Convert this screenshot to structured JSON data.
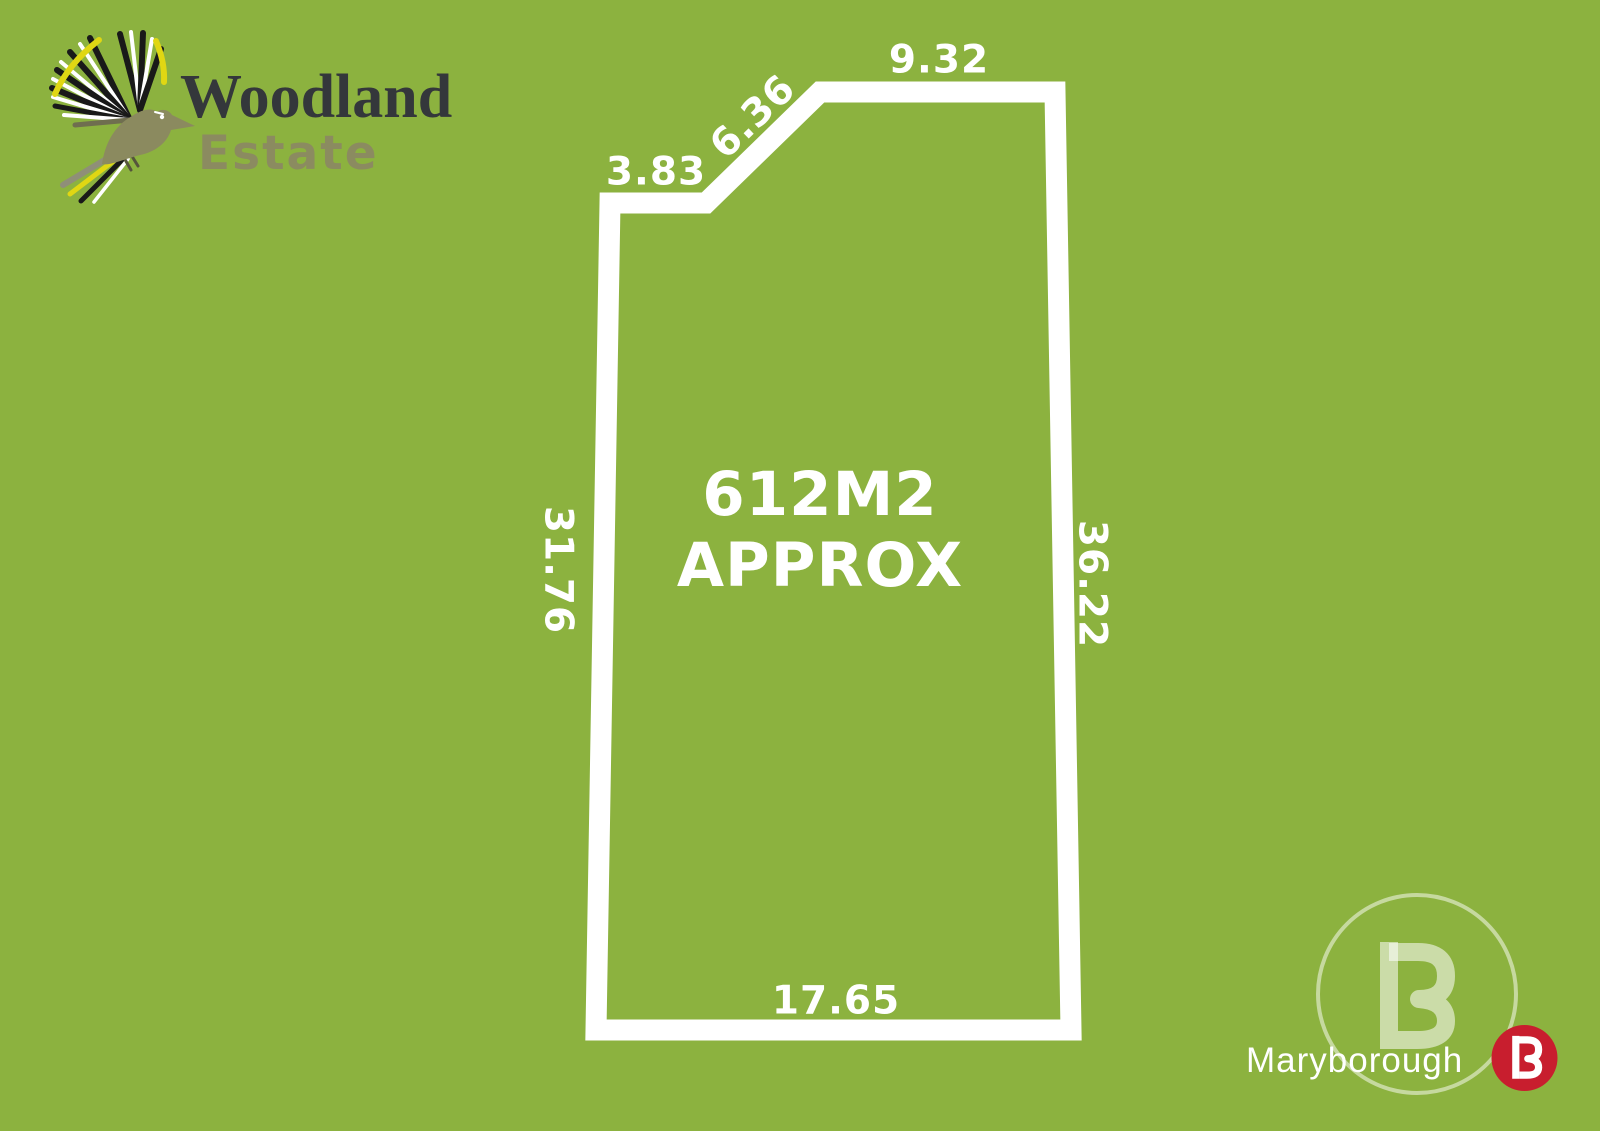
{
  "page": {
    "background_color": "#8cb23f",
    "boundary_color": "#ffffff"
  },
  "brand": {
    "line1": "Woodland",
    "line2": "Estate",
    "line1_color": "#34373b",
    "line2_color": "#8b8b60",
    "icon": "bird-icon"
  },
  "lot": {
    "area": {
      "line1": "612M2",
      "line2": "APPROX"
    },
    "dimensions": {
      "top": "9.32",
      "diagonal": "6.36",
      "upper_left": "3.83",
      "left": "31.76",
      "right": "36.22",
      "bottom": "17.65"
    }
  },
  "agency": {
    "name": "Maryborough",
    "monogram": "B",
    "badge_color": "#c81e2e",
    "mark_color": "rgba(255,255,255,0.55)"
  }
}
